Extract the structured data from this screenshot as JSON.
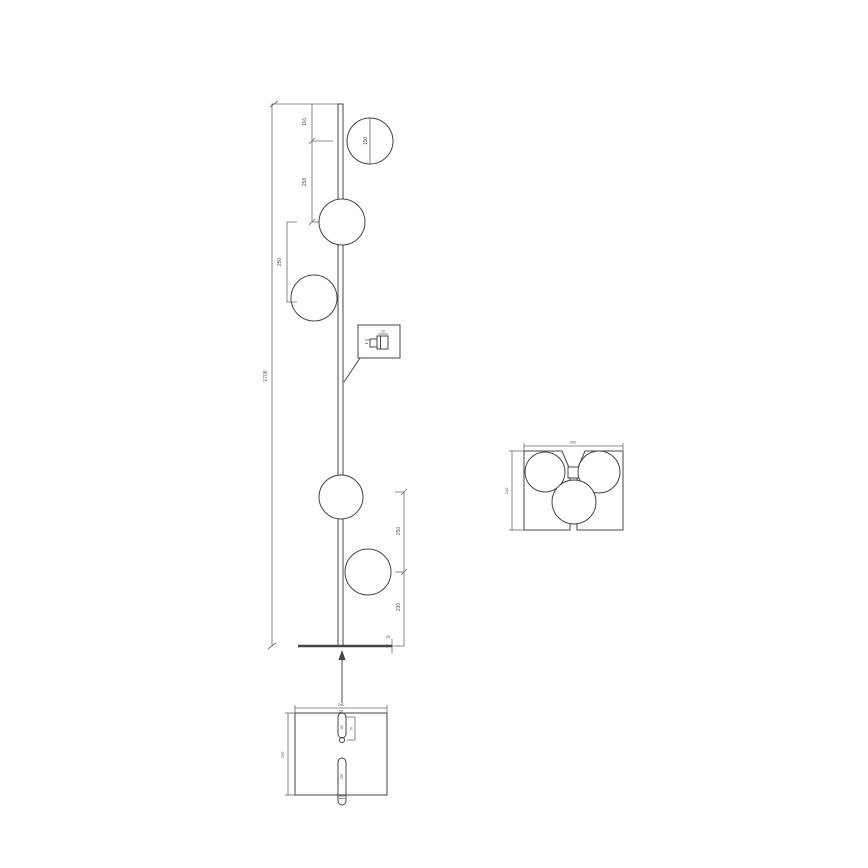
{
  "colors": {
    "line": "#454545",
    "dim": "#6a6a6a",
    "dim_text": "#555555",
    "background": "#ffffff"
  },
  "side_view": {
    "overall_height": "1708",
    "top_to_first_globe": "116",
    "first_to_second_globe": "258",
    "second_to_third_globe": "250",
    "globe_diameter": "150",
    "fourth_to_fifth_globe": "250",
    "fifth_globe_to_floor": "230",
    "base_thickness": "25",
    "switch_width": "20"
  },
  "top_view": {
    "width": "300",
    "depth": "240"
  },
  "base_view": {
    "width": "290",
    "depth": "250",
    "slot_width": "28",
    "top_slot_length": "80",
    "hole_offset": "70",
    "bottom_slot_length": "150"
  }
}
